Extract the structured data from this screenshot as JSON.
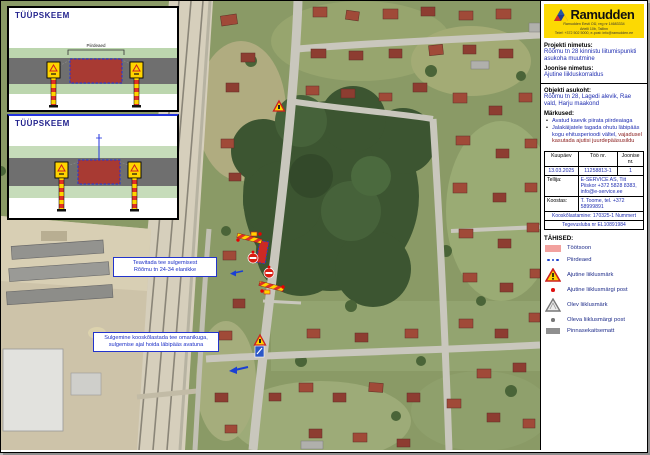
{
  "insets": {
    "panel1": {
      "title": "TÜÜPSKEEM",
      "bracket_label": "Piirdeaed"
    },
    "panel2": {
      "title": "TÜÜPSKEEM"
    }
  },
  "map_notes": {
    "note1": {
      "line1": "Teavitada tee sulgemisest",
      "line2": "Rõõmu tn 24-34 elanikke"
    },
    "note2": {
      "line1": "Sulgemine kooskõlastada tee omanikuga,",
      "line2": "sulgemise ajal hoida läbipääs avatuna"
    }
  },
  "sidebar": {
    "brand": "Ramudden",
    "brand_line1": "Ramudden Eesti OÜ, reg nr 14683334",
    "brand_line2": "Artelli 10b, Tallinn",
    "brand_line3": "Telef: +372 502 5000, e-post: info@ramudden.ee",
    "project_label": "Projekti nimetus:",
    "project_value": "Rõõmu tn 28 kinnistu liitumispunkti asukoha muutmine",
    "drawing_label": "Joonise nimetus:",
    "drawing_value": "Ajutine liikluskorraldus",
    "location_label": "Objekti asukoht:",
    "location_value": "Rõõmu tn 28, Lagedi alevik, Rae vald, Harju maakond",
    "notes_label": "Märkused:",
    "note1": "Avatud kaevik piirata piirdeaiaga",
    "note2a": "Jalakäijatele tagada ohutu läbipääs kogu ehitusperioodi vältel,",
    "note2b": "vajadusel kasutada ajutisi juurdepääsusildu",
    "table": {
      "h_date": "Kuupäev",
      "h_job": "Töö nr.",
      "h_drawing": "Joonise nr.",
      "v_date": "13.03.2025",
      "v_job": "11258813-1",
      "v_drawing": "1",
      "client_label": "Tellija:",
      "client_value": "E-SERVICE AS, Tiit Piiskor +372 5828 8383, info@e-service.ee",
      "author_label": "Koostas:",
      "author_value": "T. Toome, tel. +372 58999891",
      "footer1": "Kooskõlastamine: 170325-1 Nummert",
      "footer2": "Tegevusluba nr EL10891984"
    },
    "legend": {
      "title": "TÄHISED:",
      "items": [
        {
          "icon": "workzone-swatch",
          "label": "Töötsoon"
        },
        {
          "icon": "fence-dots",
          "label": "Piirdeaed"
        },
        {
          "icon": "temporary-sign-triangle",
          "label": "Ajutine liiklusmärk"
        },
        {
          "icon": "red-post-dot",
          "label": "Ajutine liiklusmärgi post"
        },
        {
          "icon": "existing-sign-triangle",
          "label": "Olev liiklusmärk"
        },
        {
          "icon": "gray-post-dot",
          "label": "Oleva liiklusmärgi post"
        },
        {
          "icon": "ground-mat-swatch",
          "label": "Pinnasekaitsematt"
        }
      ]
    },
    "colors": {
      "brand_yellow": "#fcd903",
      "value_blue": "#1f2db0",
      "workzone_red": "#cc2a24",
      "workzone_pink": "#f2a19e",
      "warning_yellow": "#ffd400"
    }
  }
}
